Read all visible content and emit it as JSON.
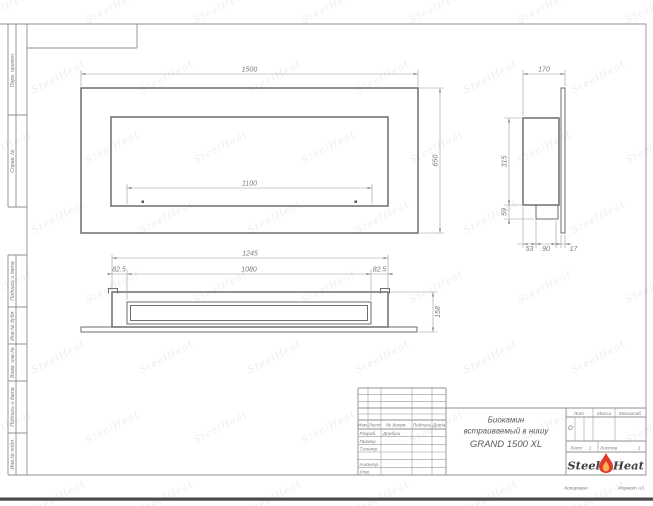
{
  "sheet": {
    "copied_label": "Копировал",
    "format_label": "Формат А3"
  },
  "side_stamps": {
    "perv_primen": "Перв. примен.",
    "sprav_no": "Справ. №",
    "podpis_data_1": "Подпись и дата",
    "inv_dubl": "Инв.№ дубл.",
    "vzam_inv": "Взам. инв.№",
    "podpis_data_2": "Подпись и дата",
    "inv_podl": "Инв.№ подл."
  },
  "title_block": {
    "header": {
      "izm": "Изм.",
      "list": "Лист",
      "doc_no": "№ докум.",
      "sign": "Подпись",
      "date": "Дата"
    },
    "rows": {
      "developed_label": "Разраб.",
      "developed_value": "Дербуш",
      "checked_label": "Провер.",
      "tcontrol_label": "Т.контр.",
      "ncontrol_label": "Н.контр.",
      "approved_label": "Утв."
    },
    "title_line1": "Биокамин",
    "title_line2": "встраиваемый в нишу",
    "title_line3": "GRAND 1500 XL",
    "lit_label": "Лит.",
    "lit_value": "О",
    "mass_label": "Масса",
    "scale_label": "Масштаб",
    "sheet_label": "Лист",
    "sheet_value": "1",
    "sheets_label": "Листов",
    "sheets_value": "1",
    "brand_word1": "Steel",
    "brand_word2": "Heat"
  },
  "views": {
    "front": {
      "width": "1500",
      "height": "650",
      "opening_width": "1100"
    },
    "side": {
      "depth": "170",
      "height": "315",
      "burner_height": "59",
      "dim_53": "53",
      "dim_90": "90",
      "dim_17": "17"
    },
    "bottom": {
      "outer_width": "1245",
      "inner_width": "1080",
      "offset_left": "82.5",
      "offset_right": "82.5",
      "depth": "158"
    }
  },
  "watermark": {
    "text": "SteelHeat"
  },
  "colors": {
    "line": "#8f8f8f",
    "object_line": "#6d6d6d",
    "dim_line": "#9c9c9c",
    "text": "#7a7a7a",
    "flame_red": "#e03a2f",
    "flame_core": "#f9b257",
    "page_edge": "#4a4a4a"
  }
}
